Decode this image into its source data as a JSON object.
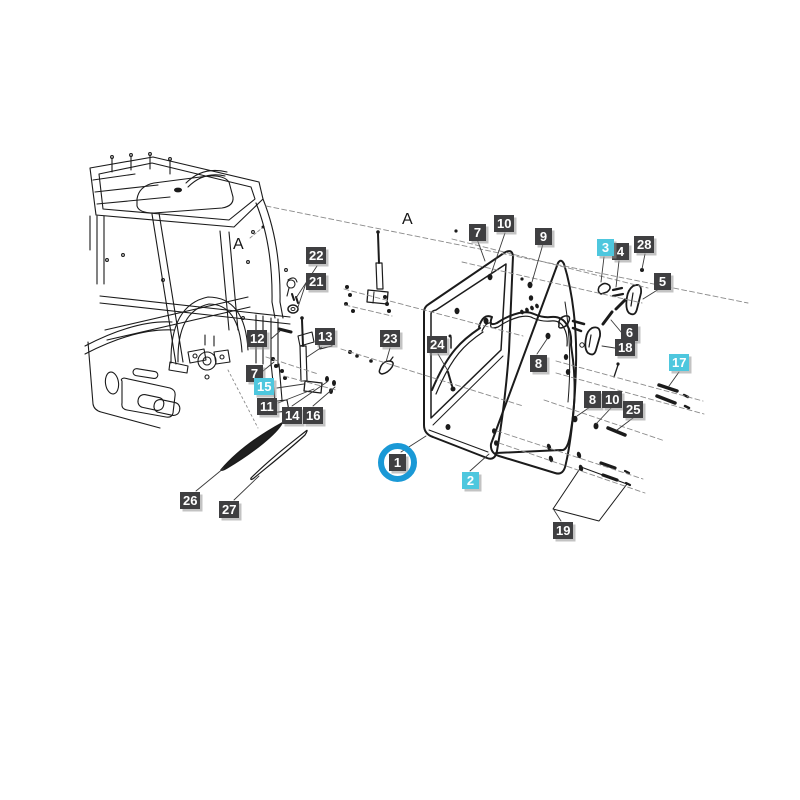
{
  "diagram": {
    "type": "exploded-parts-diagram",
    "subject": "cab door assembly",
    "axis_labels": {
      "a1": "A",
      "a2": "A"
    },
    "colors": {
      "label_bg": "#3f3f41",
      "highlight_bg": "#4ec7de",
      "label_text": "#ffffff",
      "selection_ring": "#1a99d6",
      "line": "#1b1b1b"
    },
    "labels": {
      "l1": {
        "text": "1",
        "highlighted": false,
        "circled": true
      },
      "l2": {
        "text": "2",
        "highlighted": true
      },
      "l3": {
        "text": "3",
        "highlighted": true
      },
      "l4": {
        "text": "4"
      },
      "l5": {
        "text": "5"
      },
      "l6": {
        "text": "6"
      },
      "l7a": {
        "text": "7"
      },
      "l7b": {
        "text": "7"
      },
      "l8a": {
        "text": "8"
      },
      "l8b": {
        "text": "8"
      },
      "l9": {
        "text": "9"
      },
      "l10a": {
        "text": "10"
      },
      "l10b": {
        "text": "10"
      },
      "l11": {
        "text": "11"
      },
      "l12": {
        "text": "12"
      },
      "l13": {
        "text": "13"
      },
      "l14": {
        "text": "14"
      },
      "l15": {
        "text": "15",
        "highlighted": true
      },
      "l16": {
        "text": "16"
      },
      "l17": {
        "text": "17",
        "highlighted": true
      },
      "l18": {
        "text": "18"
      },
      "l19": {
        "text": "19"
      },
      "l21": {
        "text": "21"
      },
      "l22": {
        "text": "22"
      },
      "l23": {
        "text": "23"
      },
      "l24": {
        "text": "24"
      },
      "l25": {
        "text": "25"
      },
      "l26": {
        "text": "26"
      },
      "l27": {
        "text": "27"
      },
      "l28": {
        "text": "28"
      }
    }
  }
}
